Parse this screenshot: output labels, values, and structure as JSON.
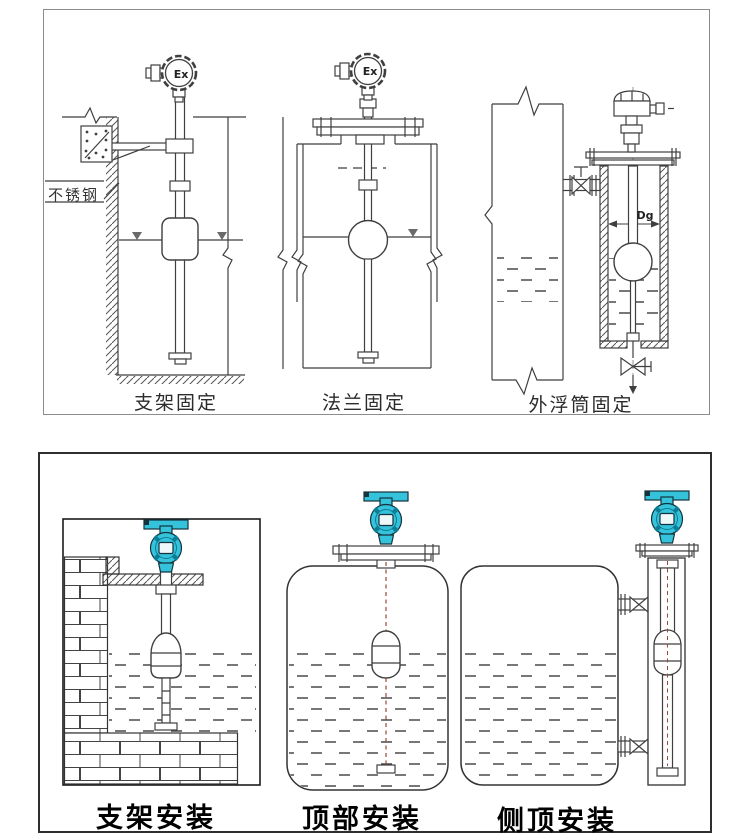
{
  "top_panel": {
    "labels": [
      "支架固定",
      "法兰固定",
      "外浮筒固定"
    ],
    "annotations": {
      "stainless_steel": "不锈钢",
      "ex_left": "Ex",
      "ex_middle": "Ex",
      "diameter": "Dg"
    }
  },
  "bottom_panel": {
    "labels": [
      "支架安装",
      "顶部安装",
      "侧顶安装"
    ]
  },
  "colors": {
    "line": "#3f3f3f",
    "dark_line": "#1c1c1c",
    "transmitter_teal": "#35c3dc",
    "transmitter_teal_dark": "#0d7d95",
    "float_wire_red": "#9a4a38",
    "top_panel_border": "#8c8c8c",
    "bottom_panel_border": "#2e2e2e",
    "background": "#ffffff"
  }
}
